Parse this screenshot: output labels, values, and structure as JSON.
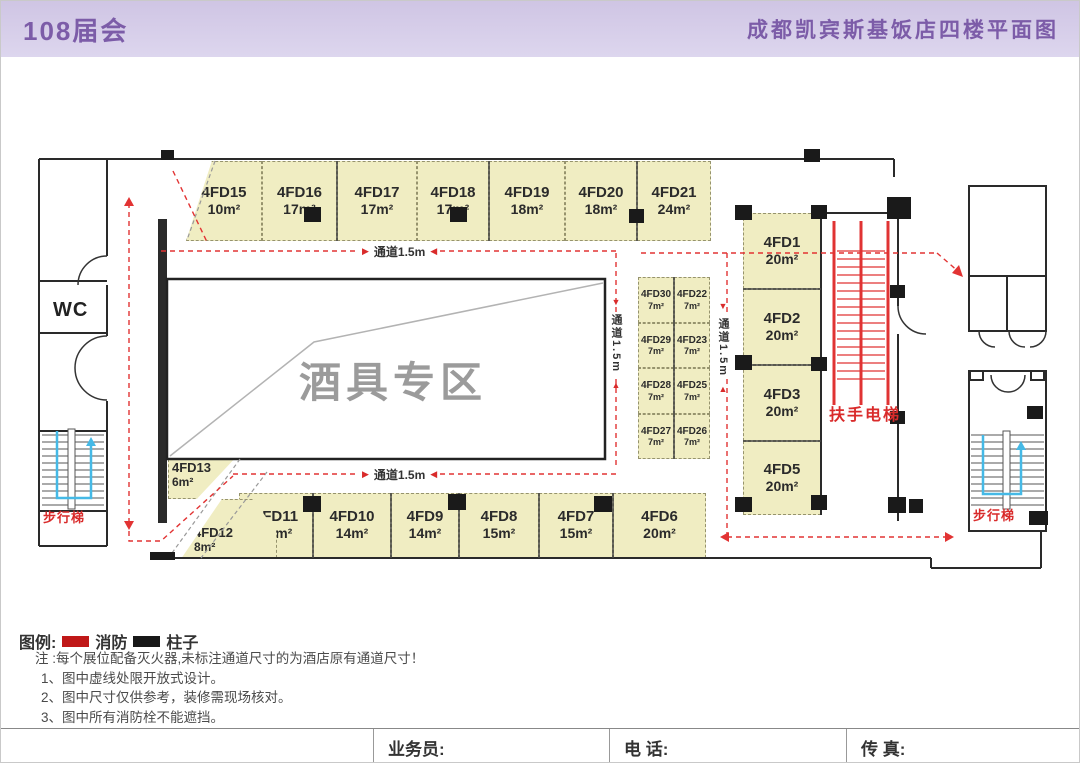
{
  "header": {
    "left_title": "108届会",
    "right_title": "成都凯宾斯基饭店四楼平面图"
  },
  "plan": {
    "zone_label": "酒具专区",
    "wc_label": "WC",
    "escalator_label": "扶手电梯",
    "stairs_left_label": "步行梯",
    "stairs_right_label": "步行梯",
    "aisle_labels": {
      "top": "通道1.5m",
      "bottom": "通道1.5m",
      "left_vertical": "通道1.5m",
      "right_vertical": "通道1.5m"
    },
    "top_row": [
      {
        "name": "4FD15",
        "area": "10m²"
      },
      {
        "name": "4FD16",
        "area": "17m²"
      },
      {
        "name": "4FD17",
        "area": "17m²"
      },
      {
        "name": "4FD18",
        "area": "17m²"
      },
      {
        "name": "4FD19",
        "area": "18m²"
      },
      {
        "name": "4FD20",
        "area": "18m²"
      },
      {
        "name": "4FD21",
        "area": "24m²"
      }
    ],
    "right_col": [
      {
        "name": "4FD1",
        "area": "20m²"
      },
      {
        "name": "4FD2",
        "area": "20m²"
      },
      {
        "name": "4FD3",
        "area": "20m²"
      },
      {
        "name": "4FD5",
        "area": "20m²"
      }
    ],
    "small_grid": [
      {
        "name": "4FD30",
        "area": "7m²"
      },
      {
        "name": "4FD22",
        "area": "7m²"
      },
      {
        "name": "4FD29",
        "area": "7m²"
      },
      {
        "name": "4FD23",
        "area": "7m²"
      },
      {
        "name": "4FD28",
        "area": "7m²"
      },
      {
        "name": "4FD25",
        "area": "7m²"
      },
      {
        "name": "4FD27",
        "area": "7m²"
      },
      {
        "name": "4FD26",
        "area": "7m²"
      }
    ],
    "bottom_row": [
      {
        "name": "4FD11",
        "area": "12m²"
      },
      {
        "name": "4FD10",
        "area": "14m²"
      },
      {
        "name": "4FD9",
        "area": "14m²"
      },
      {
        "name": "4FD8",
        "area": "15m²"
      },
      {
        "name": "4FD7",
        "area": "15m²"
      },
      {
        "name": "4FD6",
        "area": "20m²"
      }
    ],
    "corner_booths": [
      {
        "name": "4FD13",
        "area": "6m²"
      },
      {
        "name": "4FD12",
        "area": "8m²"
      }
    ]
  },
  "legend": {
    "title": "图例:",
    "items": [
      {
        "label": "消防",
        "color": "#c01818"
      },
      {
        "label": "柱子",
        "color": "#181818"
      }
    ]
  },
  "notes": {
    "intro": "注 :每个展位配备灭火器,未标注通道尺寸的为酒店原有通道尺寸！",
    "items": [
      "1、图中虚线处限开放式设计。",
      "2、图中尺寸仅供参考，装修需现场核对。",
      "3、图中所有消防栓不能遮挡。"
    ]
  },
  "footer": {
    "salesperson_label": "业务员:",
    "phone_label": "电  话:",
    "fax_label": "传  真:"
  },
  "colors": {
    "accent_purple": "#7c5ca8",
    "header_bg": "#d6cde9",
    "booth_fill": "#f0edc2",
    "fire_red": "#d92b2b",
    "column_black": "#1a1a1a",
    "stairs_cyan": "#45b9e6",
    "zone_gray": "#9b9b9b"
  }
}
